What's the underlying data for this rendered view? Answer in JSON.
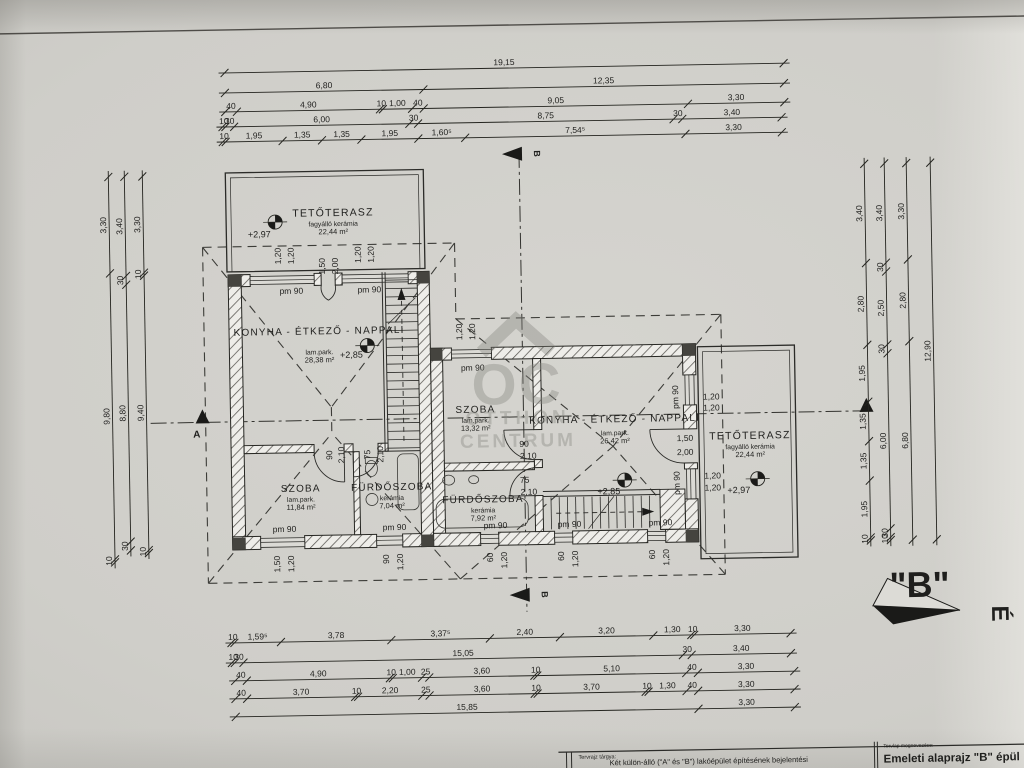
{
  "title_block": {
    "left_label": "Tervrajz tárgya:",
    "left_text": "Két külön-álló (\"A\" és \"B\") lakóépület építésének bejelentési",
    "right_label": "Tervlap megnevezése:",
    "right_text": "Emeleti alaprajz \"B\" épül"
  },
  "north": {
    "label": "\"B\"",
    "letter": "É"
  },
  "section_marks": {
    "a": "A",
    "b": "B"
  },
  "watermark": {
    "monogram": "OC",
    "line1": "OTTHON",
    "line2": "CENTRUM"
  },
  "rooms": [
    {
      "name": "TETŐTERASZ",
      "finish": "fagyálló kerámia",
      "area": "22,44 m²",
      "cx": 336,
      "cy": 213,
      "style": "terrace"
    },
    {
      "name": "KONYHA - ÉTKEZŐ - NAPPALI",
      "finish": "lam.park.",
      "area": "28,38 m²",
      "cx": 320,
      "cy": 331,
      "gap": 20
    },
    {
      "name": "SZOBA",
      "finish": "lam.park.",
      "area": "11,84 m²",
      "cx": 299,
      "cy": 488
    },
    {
      "name": "FÜRDŐSZOBA",
      "finish": "kerámia",
      "area": "7,04 m²",
      "cx": 390,
      "cy": 488
    },
    {
      "name": "SZOBA",
      "finish": "lam.park.",
      "area": "13,32 m²",
      "cx": 475,
      "cy": 412
    },
    {
      "name": "KONYHA - ÉTKEZŐ - NAPPALI",
      "finish": "lam.park.",
      "area": "26,42 m²",
      "cx": 614,
      "cy": 424,
      "gap": 13
    },
    {
      "name": "FÜRDŐSZOBA",
      "finish": "kerámia",
      "area": "7,92 m²",
      "cx": 481,
      "cy": 502
    },
    {
      "name": "TETŐTERASZ",
      "finish": "fagyálló kerámia",
      "area": "22,44 m²",
      "cx": 749,
      "cy": 443,
      "style": "terrace"
    }
  ],
  "levels": [
    {
      "text": "+2,97",
      "x": 262,
      "y": 233,
      "sx": 278,
      "sy": 218
    },
    {
      "text": "+2,85",
      "x": 352,
      "y": 355,
      "sx": 368,
      "sy": 343
    },
    {
      "text": "+2,85",
      "x": 607,
      "y": 496,
      "sx": 623,
      "sy": 482
    },
    {
      "text": "+2,97",
      "x": 737,
      "y": 497,
      "sx": 756,
      "sy": 483
    }
  ],
  "annotations": [
    {
      "t": "pm 90",
      "x": 293,
      "y": 290
    },
    {
      "t": "pm 90",
      "x": 371,
      "y": 290
    },
    {
      "t": "pm 90",
      "x": 473,
      "y": 370
    },
    {
      "t": "pm 90",
      "x": 282,
      "y": 528
    },
    {
      "t": "pm 90",
      "x": 392,
      "y": 528
    },
    {
      "t": "pm 90",
      "x": 493,
      "y": 528
    },
    {
      "t": "pm 90",
      "x": 567,
      "y": 528
    },
    {
      "t": "pm 90",
      "x": 658,
      "y": 528
    },
    {
      "t": "pm 90",
      "x": 678,
      "y": 400,
      "r": -90
    },
    {
      "t": "pm 90",
      "x": 678,
      "y": 486,
      "r": -90
    },
    {
      "t": "1,20",
      "x": 283,
      "y": 252,
      "r": -90
    },
    {
      "t": "1,20",
      "x": 296,
      "y": 252,
      "r": -90
    },
    {
      "t": "1,20",
      "x": 363,
      "y": 252,
      "r": -90
    },
    {
      "t": "1,20",
      "x": 376,
      "y": 252,
      "r": -90
    },
    {
      "t": "1,50",
      "x": 327,
      "y": 263,
      "r": -90
    },
    {
      "t": "2,00",
      "x": 340,
      "y": 263,
      "r": -90
    },
    {
      "t": "1,20",
      "x": 463,
      "y": 331,
      "r": -90
    },
    {
      "t": "1,20",
      "x": 476,
      "y": 331,
      "r": -90
    },
    {
      "t": "1,50",
      "x": 277,
      "y": 560,
      "r": -90
    },
    {
      "t": "1,20",
      "x": 291,
      "y": 560,
      "r": -90
    },
    {
      "t": "90",
      "x": 386,
      "y": 557,
      "r": -90
    },
    {
      "t": "1,20",
      "x": 400,
      "y": 560,
      "r": -90
    },
    {
      "t": "60",
      "x": 490,
      "y": 557,
      "r": -90
    },
    {
      "t": "1,20",
      "x": 504,
      "y": 560,
      "r": -90
    },
    {
      "t": "60",
      "x": 561,
      "y": 557,
      "r": -90
    },
    {
      "t": "1,20",
      "x": 575,
      "y": 560,
      "r": -90
    },
    {
      "t": "60",
      "x": 652,
      "y": 557,
      "r": -90
    },
    {
      "t": "1,20",
      "x": 666,
      "y": 560,
      "r": -90
    },
    {
      "t": "90",
      "x": 331,
      "y": 452,
      "r": -90
    },
    {
      "t": "2,10",
      "x": 343,
      "y": 452,
      "r": -90
    },
    {
      "t": "75",
      "x": 369,
      "y": 452,
      "r": -90
    },
    {
      "t": "2,10",
      "x": 382,
      "y": 452,
      "r": -90
    },
    {
      "t": "90",
      "x": 523,
      "y": 447
    },
    {
      "t": "2,10",
      "x": 527,
      "y": 459
    },
    {
      "t": "75",
      "x": 523,
      "y": 483
    },
    {
      "t": "2,10",
      "x": 527,
      "y": 495
    },
    {
      "t": "1,20",
      "x": 711,
      "y": 403
    },
    {
      "t": "1,20",
      "x": 711,
      "y": 414
    },
    {
      "t": "1,50",
      "x": 684,
      "y": 444
    },
    {
      "t": "2,00",
      "x": 684,
      "y": 458
    },
    {
      "t": "1,20",
      "x": 711,
      "y": 482
    },
    {
      "t": "1,20",
      "x": 711,
      "y": 494
    }
  ],
  "dim_chains": [
    {
      "dir": "h",
      "x": 230,
      "y": 68,
      "segs": [
        "19,15"
      ]
    },
    {
      "dir": "h",
      "x": 230,
      "y": 88,
      "segs": [
        "6,80",
        "12,35"
      ]
    },
    {
      "dir": "h",
      "x": 230,
      "y": 107,
      "segs": [
        "40",
        "4,90",
        "10",
        "1,00",
        "40",
        "9,05",
        "3,30"
      ]
    },
    {
      "dir": "h",
      "x": 227,
      "y": 122,
      "segs": [
        "10",
        "30",
        "6,00",
        "30",
        "8,75",
        "30",
        "3,40"
      ]
    },
    {
      "dir": "h",
      "x": 227,
      "y": 137,
      "segs": [
        "10",
        "1,95",
        "1,35",
        "1,35",
        "1,95",
        "1,60⁵",
        "7,54⁵",
        "3,30"
      ]
    },
    {
      "dir": "h",
      "x": 227,
      "y": 638,
      "segs": [
        "10",
        "1,59⁵",
        "3,78",
        "3,37⁵",
        "2,40",
        "3,20",
        "1,30",
        "10",
        "3,30"
      ]
    },
    {
      "dir": "h",
      "x": 227,
      "y": 658,
      "segs": [
        "10",
        "30",
        "15,05",
        "30",
        "3,40"
      ]
    },
    {
      "dir": "h",
      "x": 230,
      "y": 676,
      "segs": [
        "40",
        "4,90",
        "10",
        "1,00",
        "25",
        "3,60",
        "10",
        "5,10",
        "40",
        "3,30"
      ]
    },
    {
      "dir": "h",
      "x": 230,
      "y": 694,
      "segs": [
        "40",
        "3,70",
        "10",
        "2,20",
        "25",
        "3,60",
        "10",
        "3,70",
        "10",
        "1,30",
        "40",
        "3,30"
      ]
    },
    {
      "dir": "h",
      "x": 230,
      "y": 712,
      "segs": [
        "15,85",
        "3,30"
      ]
    },
    {
      "dir": "v",
      "x": 112,
      "y": 170,
      "segs": [
        "3,30",
        "9,80",
        "10"
      ]
    },
    {
      "dir": "v",
      "x": 128,
      "y": 170,
      "segs": [
        "3,40",
        "30",
        "8,80",
        "30"
      ]
    },
    {
      "dir": "v",
      "x": 146,
      "y": 170,
      "segs": [
        "3,30",
        "10",
        "9,40",
        "10"
      ]
    },
    {
      "dir": "v",
      "x": 868,
      "y": 170,
      "segs": [
        "3,40",
        "2,80",
        "1,95",
        "1,35",
        "1,35",
        "1,95",
        "10"
      ]
    },
    {
      "dir": "v",
      "x": 888,
      "y": 170,
      "segs": [
        "3,40",
        "30",
        "2,50",
        "30",
        "6,00",
        "30",
        "10"
      ]
    },
    {
      "dir": "v",
      "x": 910,
      "y": 170,
      "segs": [
        "3,30",
        "2,80",
        "6,80"
      ]
    },
    {
      "dir": "v",
      "x": 934,
      "y": 170,
      "segs": [
        "12,90"
      ]
    }
  ]
}
